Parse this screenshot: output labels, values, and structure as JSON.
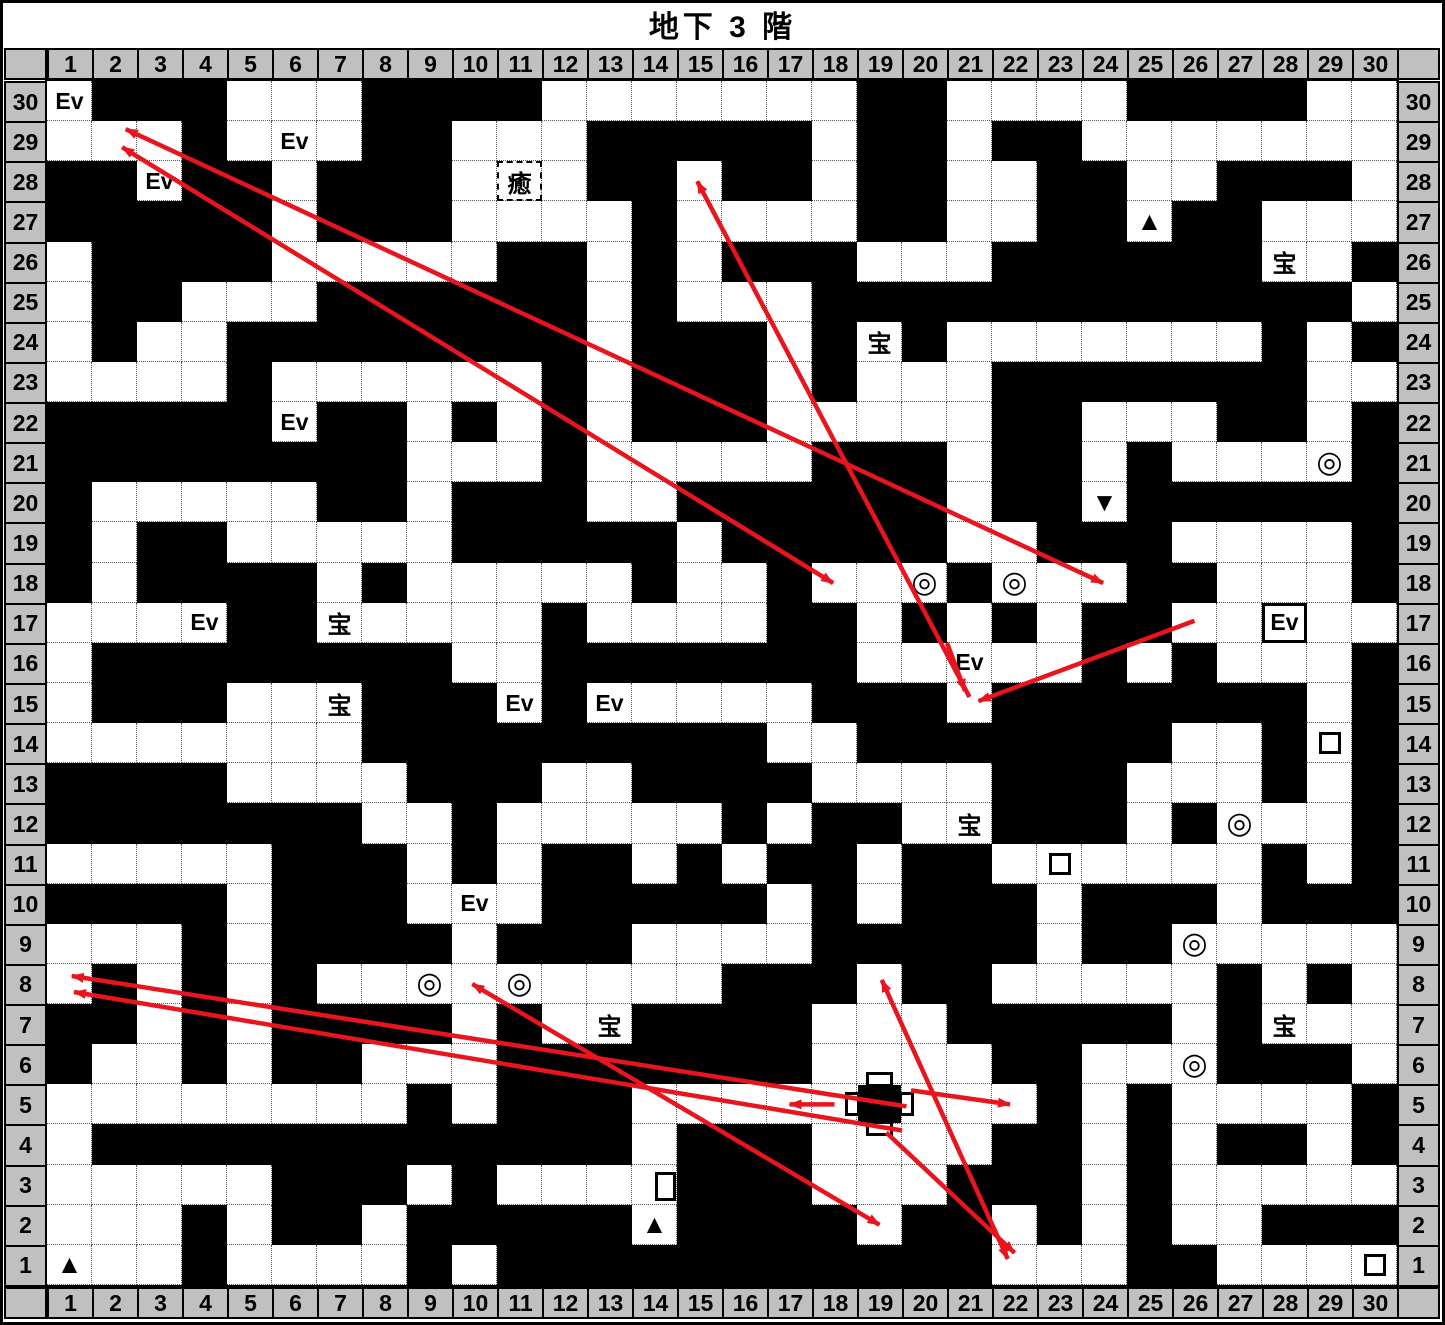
{
  "title": "地下 3 階",
  "floor_label": "地下 3 階",
  "headers": {
    "cols": [
      1,
      2,
      3,
      4,
      5,
      6,
      7,
      8,
      9,
      10,
      11,
      12,
      13,
      14,
      15,
      16,
      17,
      18,
      19,
      20,
      21,
      22,
      23,
      24,
      25,
      26,
      27,
      28,
      29,
      30
    ],
    "rows_top_to_bottom": [
      30,
      29,
      28,
      27,
      26,
      25,
      24,
      23,
      22,
      21,
      20,
      19,
      18,
      17,
      16,
      15,
      14,
      13,
      12,
      11,
      10,
      9,
      8,
      7,
      6,
      5,
      4,
      3,
      2,
      1
    ]
  },
  "grid": {
    "cols": 30,
    "rows": 30,
    "wall_rows_top_to_bottom": [
      "011100011110000000110000111100",
      "000100011000111110110110000000",
      "110110111000110110110011001110",
      "111110111000010000110011011000",
      "011110000011010111000111111001",
      "011000111111010001111111111110",
      "010011111111011101010000000101",
      "000010000001011101000111111100",
      "111110110101011100000110001101",
      "111111110001000001110110100001",
      "100000110111001111110110111111",
      "101100000111110111110011100001",
      "101111010000010010001000110001",
      "000011000001000011010101100000",
      "011111111001111111000001010001",
      "011100011101000001110111111101",
      "000000011111111100111111100101",
      "111100001110011110000111000101",
      "111111100100000101100111010001",
      "000001110101101011011000000101",
      "111101110001111101011101110111",
      "000101111011100001111101100000",
      "010101000000000111011000001010",
      "110101111010011110001111101000",
      "100101100011111110000110001110",
      "000000001011100000000010100001",
      "011111111111101110000110101101",
      "000001110100001110001110100000",
      "000101101111101111011010100111",
      "000100001011111111111000110000"
    ],
    "legend": {
      "0": "open-floor",
      "1": "wall-solid"
    }
  },
  "markers": [
    {
      "type": "event",
      "label": "Ev",
      "col": 1,
      "row": 30
    },
    {
      "type": "event",
      "label": "Ev",
      "col": 6,
      "row": 29
    },
    {
      "type": "event",
      "label": "Ev",
      "col": 3,
      "row": 28
    },
    {
      "type": "heal",
      "label": "癒",
      "col": 11,
      "row": 28
    },
    {
      "type": "up-stairs",
      "label": "▲",
      "col": 25,
      "row": 27
    },
    {
      "type": "treasure",
      "label": "宝",
      "col": 28,
      "row": 26
    },
    {
      "type": "treasure",
      "label": "宝",
      "col": 19,
      "row": 24
    },
    {
      "type": "event",
      "label": "Ev",
      "col": 6,
      "row": 22
    },
    {
      "type": "double-circle",
      "label": "◎",
      "col": 29,
      "row": 21
    },
    {
      "type": "down-stairs",
      "label": "▼",
      "col": 24,
      "row": 20
    },
    {
      "type": "event",
      "label": "Ev",
      "col": 16,
      "row": 19
    },
    {
      "type": "double-circle",
      "label": "◎",
      "col": 20,
      "row": 18
    },
    {
      "type": "double-circle",
      "label": "◎",
      "col": 22,
      "row": 18
    },
    {
      "type": "event",
      "label": "Ev",
      "col": 4,
      "row": 17
    },
    {
      "type": "treasure",
      "label": "宝",
      "col": 7,
      "row": 17
    },
    {
      "type": "event-boxed",
      "label": "Ev",
      "col": 28,
      "row": 17
    },
    {
      "type": "event",
      "label": "Ev",
      "col": 21,
      "row": 16
    },
    {
      "type": "treasure",
      "label": "宝",
      "col": 7,
      "row": 15
    },
    {
      "type": "event",
      "label": "Ev",
      "col": 11,
      "row": 15
    },
    {
      "type": "event",
      "label": "Ev",
      "col": 13,
      "row": 15
    },
    {
      "type": "square",
      "label": "□",
      "col": 29,
      "row": 14
    },
    {
      "type": "treasure",
      "label": "宝",
      "col": 21,
      "row": 12
    },
    {
      "type": "double-circle",
      "label": "◎",
      "col": 27,
      "row": 12
    },
    {
      "type": "shop",
      "label": "店",
      "col": 15,
      "row": 11
    },
    {
      "type": "square",
      "label": "□",
      "col": 23,
      "row": 11
    },
    {
      "type": "event",
      "label": "Ev",
      "col": 10,
      "row": 10
    },
    {
      "type": "double-circle",
      "label": "◎",
      "col": 26,
      "row": 9
    },
    {
      "type": "double-circle",
      "label": "◎",
      "col": 9,
      "row": 8
    },
    {
      "type": "double-circle",
      "label": "◎",
      "col": 11,
      "row": 8
    },
    {
      "type": "treasure",
      "label": "宝",
      "col": 13,
      "row": 7
    },
    {
      "type": "treasure",
      "label": "宝",
      "col": 28,
      "row": 7
    },
    {
      "type": "double-circle",
      "label": "◎",
      "col": 26,
      "row": 6
    },
    {
      "type": "up-stairs",
      "label": "▲",
      "col": 14,
      "row": 2
    },
    {
      "type": "up-stairs",
      "label": "▲",
      "col": 1,
      "row": 1
    },
    {
      "type": "square",
      "label": "□",
      "col": 30,
      "row": 1
    }
  ],
  "special_icons": [
    {
      "type": "cross-block",
      "col": 19,
      "row": 5
    },
    {
      "type": "door-rect",
      "col": 14,
      "row": 3,
      "edge": "right"
    }
  ],
  "teleport_arrows": [
    {
      "from": [
        17.97,
        17.99
      ],
      "to": [
        2.17,
        28.85
      ],
      "double": true
    },
    {
      "from": [
        23.97,
        17.99
      ],
      "to": [
        2.25,
        29.3
      ],
      "double": true
    },
    {
      "from": [
        21.0,
        15.15
      ],
      "to": [
        14.95,
        28.0
      ],
      "double": false
    },
    {
      "from": [
        20.5,
        16.5
      ],
      "to": [
        20.9,
        15.3
      ],
      "double": false
    },
    {
      "from": [
        26.0,
        17.05
      ],
      "to": [
        21.2,
        15.05
      ],
      "double": false
    },
    {
      "from": [
        21.85,
        1.15
      ],
      "to": [
        19.05,
        8.1
      ],
      "double": true
    },
    {
      "from": [
        19.15,
        4.3
      ],
      "to": [
        22.0,
        1.3
      ],
      "double": false
    },
    {
      "from": [
        19.6,
        4.95
      ],
      "to": [
        1.05,
        8.2
      ],
      "double": false
    },
    {
      "from": [
        19.5,
        4.35
      ],
      "to": [
        1.1,
        7.8
      ],
      "double": false
    },
    {
      "from": [
        18.0,
        5.0
      ],
      "to": [
        17.0,
        5.0
      ],
      "double": false
    },
    {
      "from": [
        19.7,
        5.35
      ],
      "to": [
        21.9,
        5.0
      ],
      "double": false
    },
    {
      "from": [
        9.95,
        8.0
      ],
      "to": [
        19.0,
        2.0
      ],
      "double": true
    }
  ],
  "colors": {
    "wall": "#000000",
    "floor": "#ffffff",
    "header_bg": "#c0c0c0",
    "arrow_red": "#e8141e",
    "gridline": "#555555"
  }
}
